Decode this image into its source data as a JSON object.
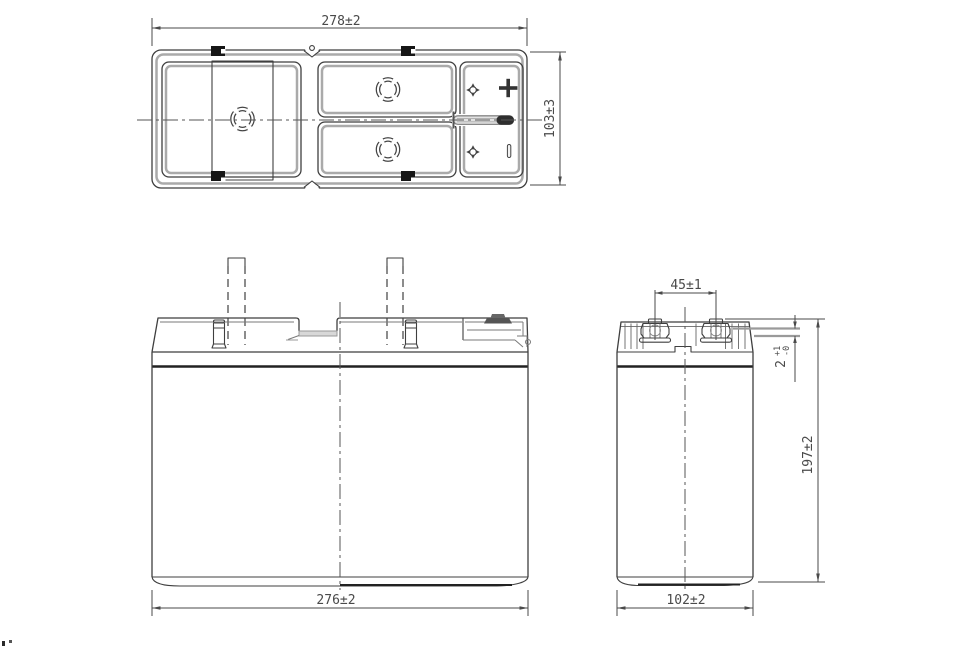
{
  "drawing": {
    "type": "battery-outline-dimension-drawing",
    "views": {
      "top_view": {
        "width_dim": "278±2",
        "depth_dim": "103±3",
        "polarity_icons": {
          "positive": "+",
          "negative": "−"
        }
      },
      "front_view": {
        "width_dim": "276±2"
      },
      "side_view": {
        "width_dim": "102±2",
        "height_dim": "197±2",
        "terminal_pitch_dim": "45±1",
        "terminal_protrusion": {
          "value": "2",
          "tol_plus": "+1",
          "tol_minus": "-0"
        }
      }
    }
  }
}
